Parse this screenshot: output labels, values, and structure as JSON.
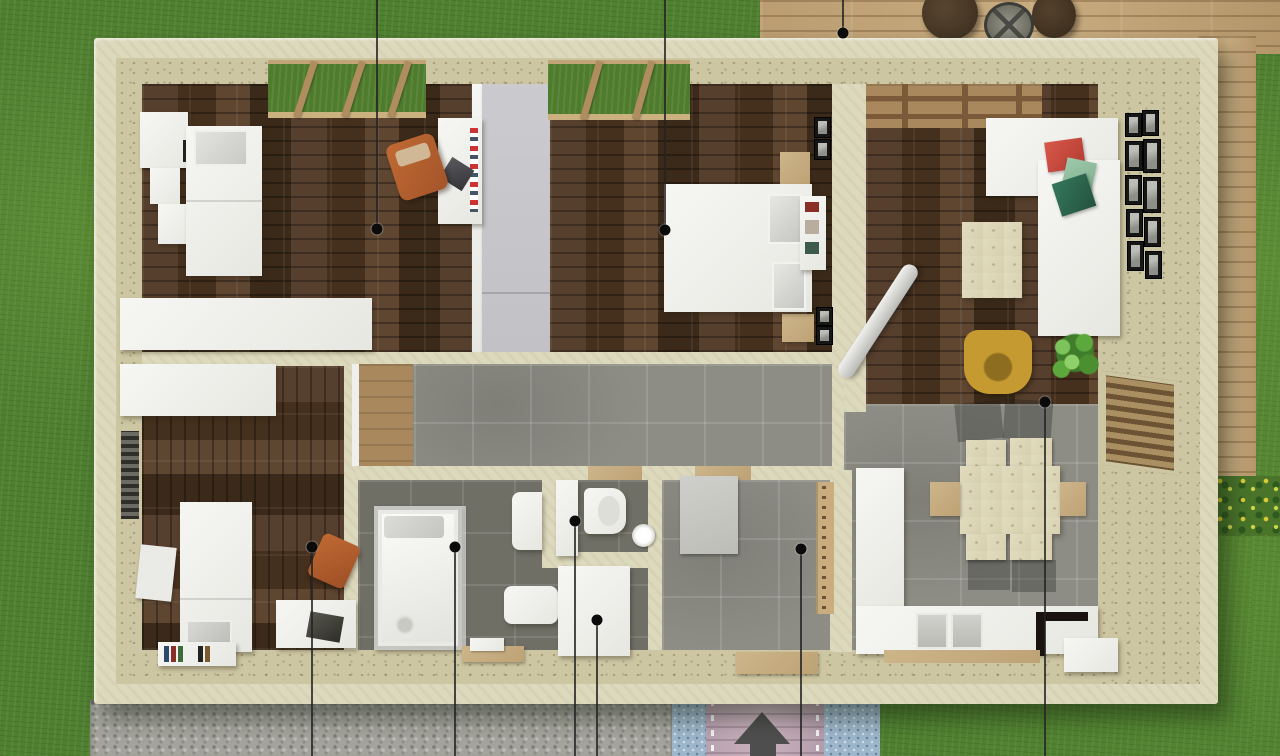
{
  "meta": {
    "type": "3d-floorplan-top-view-render",
    "canvas": {
      "width": 1280,
      "height": 756
    },
    "visible_text": "none"
  },
  "palette": {
    "grass": "#4f8030",
    "deck_wood": "#bb9d71",
    "gravel": "#a4a49c",
    "walkway_mauve": "#c0a8b5",
    "walkway_blue": "#9db6ca",
    "wall_outer": "#ddd9bd",
    "wall_face": "#cdc6a2",
    "floor_wood_dark": "#4c3725",
    "floor_tile": "#8d8d85",
    "bath_tile": "#6f6f66",
    "furniture_white": "#f4f4f1",
    "wardrobe_gray": "#c7c7cb",
    "chair_orange": "#b9602d",
    "chair_mustard": "#c49a30",
    "pillow_red": "#c94f43",
    "pillow_green_light": "#94bfa2",
    "pillow_green_dark": "#2f6b52",
    "plant_green": "#5ca83c",
    "arrow_gray": "#4e4e4e",
    "marker_black": "#0b0b0b"
  },
  "environment": {
    "lawn": "surrounding grass on all sides",
    "deck_top": "wooden terrace along top edge with two dark round side tables and a wire lantern",
    "deck_right": "wooden terrace strip along right side",
    "garden_bed": "flower bed with yellow blooms on right side",
    "gravel_path": "pebble path along bottom-left",
    "entrance_walkway": {
      "style": "mauve boardwalk with blue pebble borders",
      "arrow_direction": "up-toward-house"
    }
  },
  "house": {
    "rooms": [
      {
        "id": "study",
        "floor": "dark-wood",
        "furniture": [
          "stepped-wall-shelves",
          "single-bed-with-pillow",
          "low-cabinet-row",
          "desk",
          "laptop",
          "orange-office-chair",
          "top-window"
        ]
      },
      {
        "id": "bedroom",
        "floor": "dark-wood",
        "furniture": [
          "gray-wardrobe-wall",
          "double-bed",
          "two-gray-pillows",
          "headboard-shelf",
          "two-nightstands",
          "black-wall-frames",
          "top-window"
        ]
      },
      {
        "id": "living-room",
        "floor": "dark-wood",
        "furniture": [
          "pergola-beams",
          "white-corner-sofa",
          "red-cushion",
          "light-green-cushion",
          "dark-green-cushion",
          "coffee-table",
          "mustard-lounge-chair",
          "potted-plant",
          "stove-pipe",
          "gallery-picture-wall"
        ]
      },
      {
        "id": "dining",
        "floor": "gray-tile",
        "furniture": [
          "plywood-dining-table",
          "six-chairs"
        ]
      },
      {
        "id": "kitchen",
        "floor": "gray-tile",
        "furniture": [
          "tall-unit-column",
          "base-counter",
          "double-sink",
          "black-cooktop",
          "island-block",
          "wood-plinth"
        ]
      },
      {
        "id": "hallway",
        "floor": "gray-tile",
        "furniture": [
          "wood-door-leaf"
        ]
      },
      {
        "id": "bathroom",
        "floor": "dark-tile",
        "furniture": [
          "glass-shower",
          "two-wall-basins",
          "tall-white-cabinet",
          "towels",
          "wood-tray"
        ]
      },
      {
        "id": "wc",
        "floor": "dark-tile",
        "furniture": [
          "toilet",
          "paper-roll"
        ]
      },
      {
        "id": "utility",
        "floor": "dark-tile",
        "furniture": [
          "white-storage-cabinet"
        ]
      },
      {
        "id": "entry",
        "floor": "gray-tile",
        "furniture": [
          "gray-doormat",
          "coat-rack",
          "front-door-threshold"
        ]
      },
      {
        "id": "kids-bedroom",
        "floor": "dark-wood",
        "furniture": [
          "single-bed",
          "gray-pillow",
          "white-rug",
          "bookshelf-with-books",
          "desk",
          "laptop",
          "orange-chair",
          "louvered-left-window",
          "low-cabinet-row"
        ]
      }
    ]
  },
  "markers": [
    {
      "id": "m1",
      "x": 377,
      "y": 229,
      "line": "from-top",
      "area": "study"
    },
    {
      "id": "m2",
      "x": 665,
      "y": 230,
      "line": "from-top",
      "area": "bedroom"
    },
    {
      "id": "m3",
      "x": 843,
      "y": 33,
      "line": "from-top",
      "area": "terrace"
    },
    {
      "id": "m4",
      "x": 312,
      "y": 547,
      "line": "to-bottom",
      "area": "kids-bedroom"
    },
    {
      "id": "m5",
      "x": 455,
      "y": 547,
      "line": "to-bottom",
      "area": "shower"
    },
    {
      "id": "m6",
      "x": 575,
      "y": 521,
      "line": "to-bottom",
      "area": "bathroom"
    },
    {
      "id": "m7",
      "x": 597,
      "y": 620,
      "line": "to-bottom",
      "area": "utility"
    },
    {
      "id": "m8",
      "x": 801,
      "y": 549,
      "line": "to-bottom",
      "area": "entry"
    },
    {
      "id": "m9",
      "x": 1045,
      "y": 402,
      "line": "to-bottom",
      "area": "kitchen-dining"
    }
  ]
}
